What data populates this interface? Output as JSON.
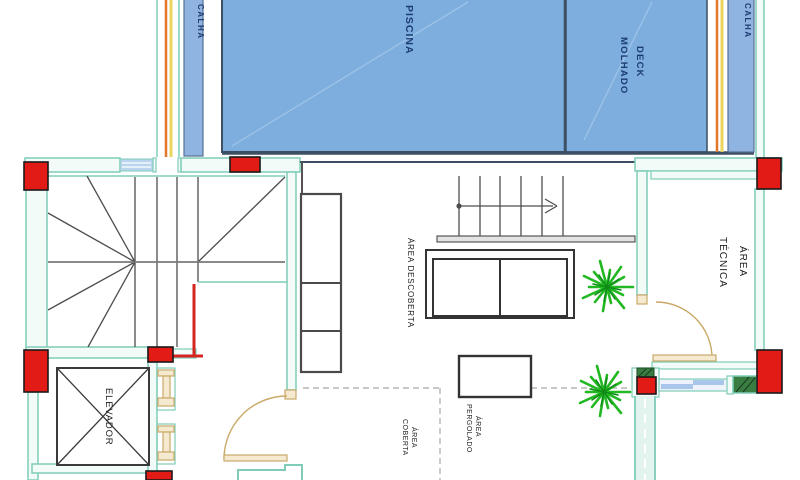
{
  "drawing": {
    "type": "architectural-floor-plan",
    "labels": {
      "piscina": "PISCINA",
      "deck_line1": "DECK",
      "deck_line2": "MOLHADO",
      "calha_left": "CALHA",
      "calha_right": "CALHA",
      "area_tecnica_line1": "ÁREA",
      "area_tecnica_line2": "TÉCNICA",
      "area_descoberta": "ÁREA DESCOBERTA",
      "elevador": "ELEVADOR",
      "area_coberta_line1": "ÁREA",
      "area_coberta_line2": "COBERTA",
      "area_pergolado_line1": "ÁREA",
      "area_pergolado_line2": "PERGOLADO"
    },
    "colors": {
      "pool_blue": "#7daede",
      "pool_edge": "#3d4f63",
      "wall_teal": "#7fcdb8",
      "column_red": "#e31b17",
      "calha_orange": "#e2762a",
      "calha_yellow": "#ead55e",
      "calha_strip_blue": "#8fb4e2",
      "label_navy": "#1c3c72",
      "label_dark": "#1c1c1c",
      "plant_green": "#22b822",
      "door_tan": "#c9a968",
      "hatch_green": "#3a7d42",
      "window_blue": "#a9c6ea",
      "line_gray": "#4d4d4d"
    }
  }
}
